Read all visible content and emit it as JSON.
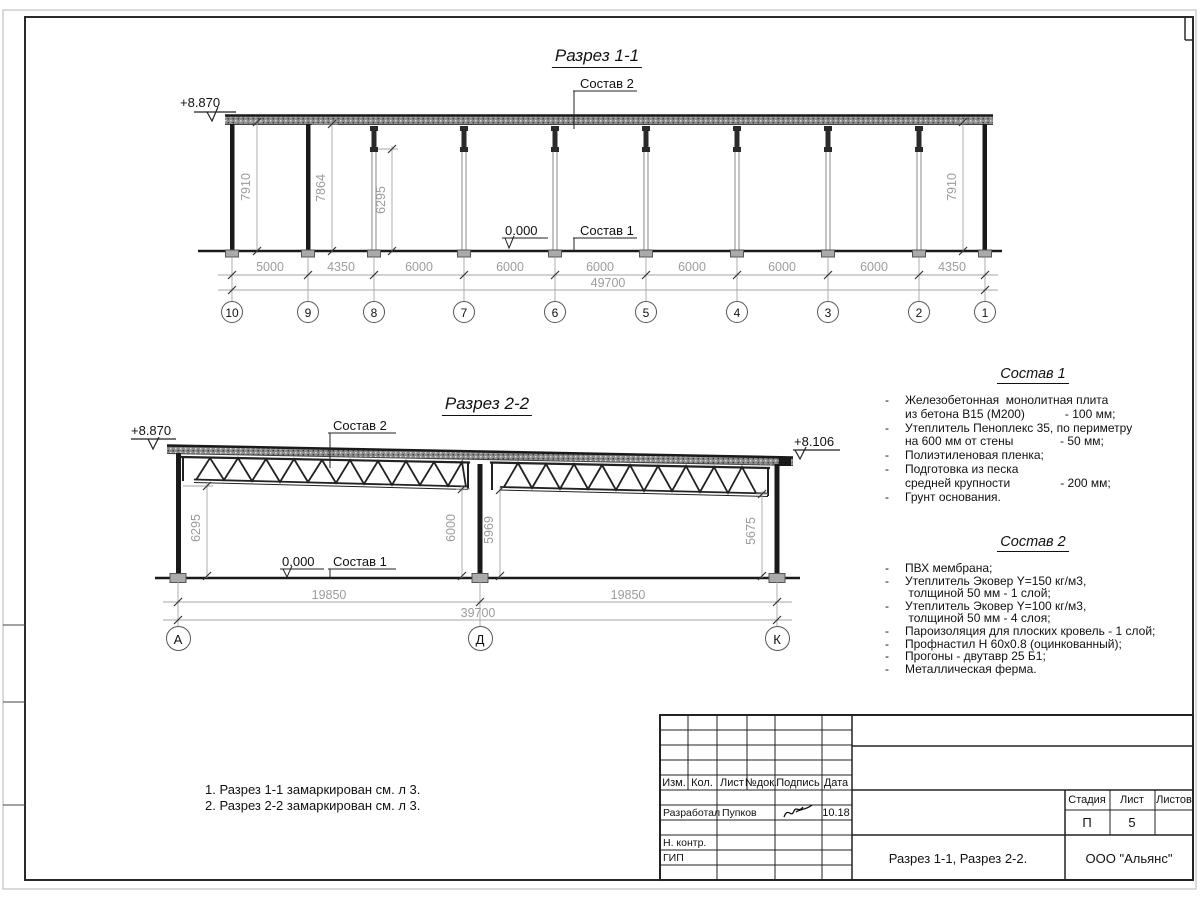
{
  "s11": {
    "title": "Разрез 1-1",
    "elev_top": "+8.870",
    "zero": "0.000",
    "lbl_sostav2": "Состав 2",
    "lbl_sostav1": "Состав 1",
    "vdims": [
      "7910",
      "7864",
      "6295",
      "7910"
    ],
    "dims": [
      "5000",
      "4350",
      "6000",
      "6000",
      "6000",
      "6000",
      "6000",
      "6000",
      "4350"
    ],
    "total": "49700",
    "grids": [
      "10",
      "9",
      "8",
      "7",
      "6",
      "5",
      "4",
      "3",
      "2",
      "1"
    ]
  },
  "s22": {
    "title": "Разрез 2-2",
    "elev_left": "+8.870",
    "elev_right": "+8.106",
    "zero": "0.000",
    "lbl_sostav2": "Состав 2",
    "lbl_sostav1": "Состав 1",
    "vdims": [
      "6295",
      "6000",
      "5969",
      "5675"
    ],
    "dims": [
      "19850",
      "19850"
    ],
    "total": "39700",
    "grids": [
      "А",
      "Д",
      "К"
    ]
  },
  "sostav1": {
    "title": "Состав 1",
    "dash": "-",
    "items": [
      "Железобетонная  монолитная плита\nиз бетона В15 (М200)            - 100 мм;",
      "Утеплитель Пеноплекс 35, по периметру\nна 600 мм от стены              - 50 мм;",
      "Полиэтиленовая пленка;",
      "Подготовка из песка\nсредней крупности               - 200 мм;",
      "Грунт основания."
    ]
  },
  "sostav2": {
    "title": "Состав 2",
    "dash": "-",
    "items": [
      "ПВХ мембрана;",
      "Утеплитель Эковер Y=150 кг/м3,\n толщиной 50 мм - 1 слой;",
      "Утеплитель Эковер Y=100 кг/м3,\n толщиной 50 мм - 4 слоя;",
      "Пароизоляция для плоских кровель - 1 слой;",
      "Профнастил Н 60х0.8 (оцинкованный);",
      "Прогоны - двутавр 25 Б1;",
      "Металлическая ферма."
    ]
  },
  "notes": [
    "1. Разрез 1-1 замаркирован см. л 3.",
    "2. Разрез 2-2 замаркирован см. л 3."
  ],
  "stamp": {
    "h_izm": "Изм.",
    "h_kol": "Кол.",
    "h_list": "Лист",
    "h_ndok": "№док.",
    "h_podpis": "Подпись",
    "h_data": "Дата",
    "razrabotal": "Разработал",
    "razrabotal_name": "Пупков",
    "razrabotal_date": "10.18",
    "nkontr": "Н. контр.",
    "gip": "ГИП",
    "h_stadia": "Стадия",
    "h_sheet": "Лист",
    "h_sheets": "Листов",
    "stadia": "П",
    "sheet": "5",
    "doc_title": "Разрез 1-1, Разрез 2-2.",
    "company": "ООО \"Альянс\""
  }
}
